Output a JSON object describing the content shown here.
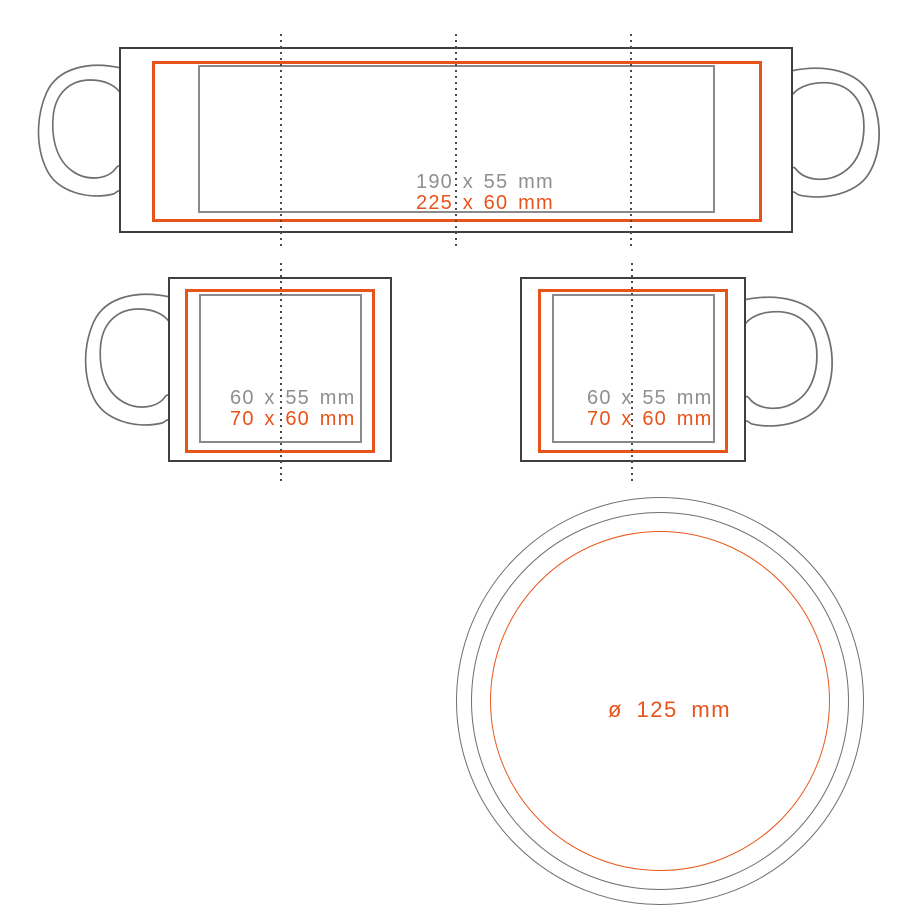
{
  "diagram_title": "mug-print-area-template",
  "colors": {
    "accent_orange": "#e8531a",
    "safe_area_gray": "#8a8a8a",
    "body_outline": "#3f3f3f",
    "handle_gray": "#6f6f6f",
    "guide_dots": "#4a4a4a",
    "gray_text": "#8f8f8f"
  },
  "wrap_view": {
    "print_label": "190 x 55 mm",
    "bleed_label": "225 x 60 mm"
  },
  "front_left": {
    "print_label": "60 x 55 mm",
    "bleed_label": "70 x 60 mm"
  },
  "front_right": {
    "print_label": "60 x 55 mm",
    "bleed_label": "70 x 60 mm"
  },
  "bottom_view": {
    "diameter_label": "ø 125 mm"
  }
}
